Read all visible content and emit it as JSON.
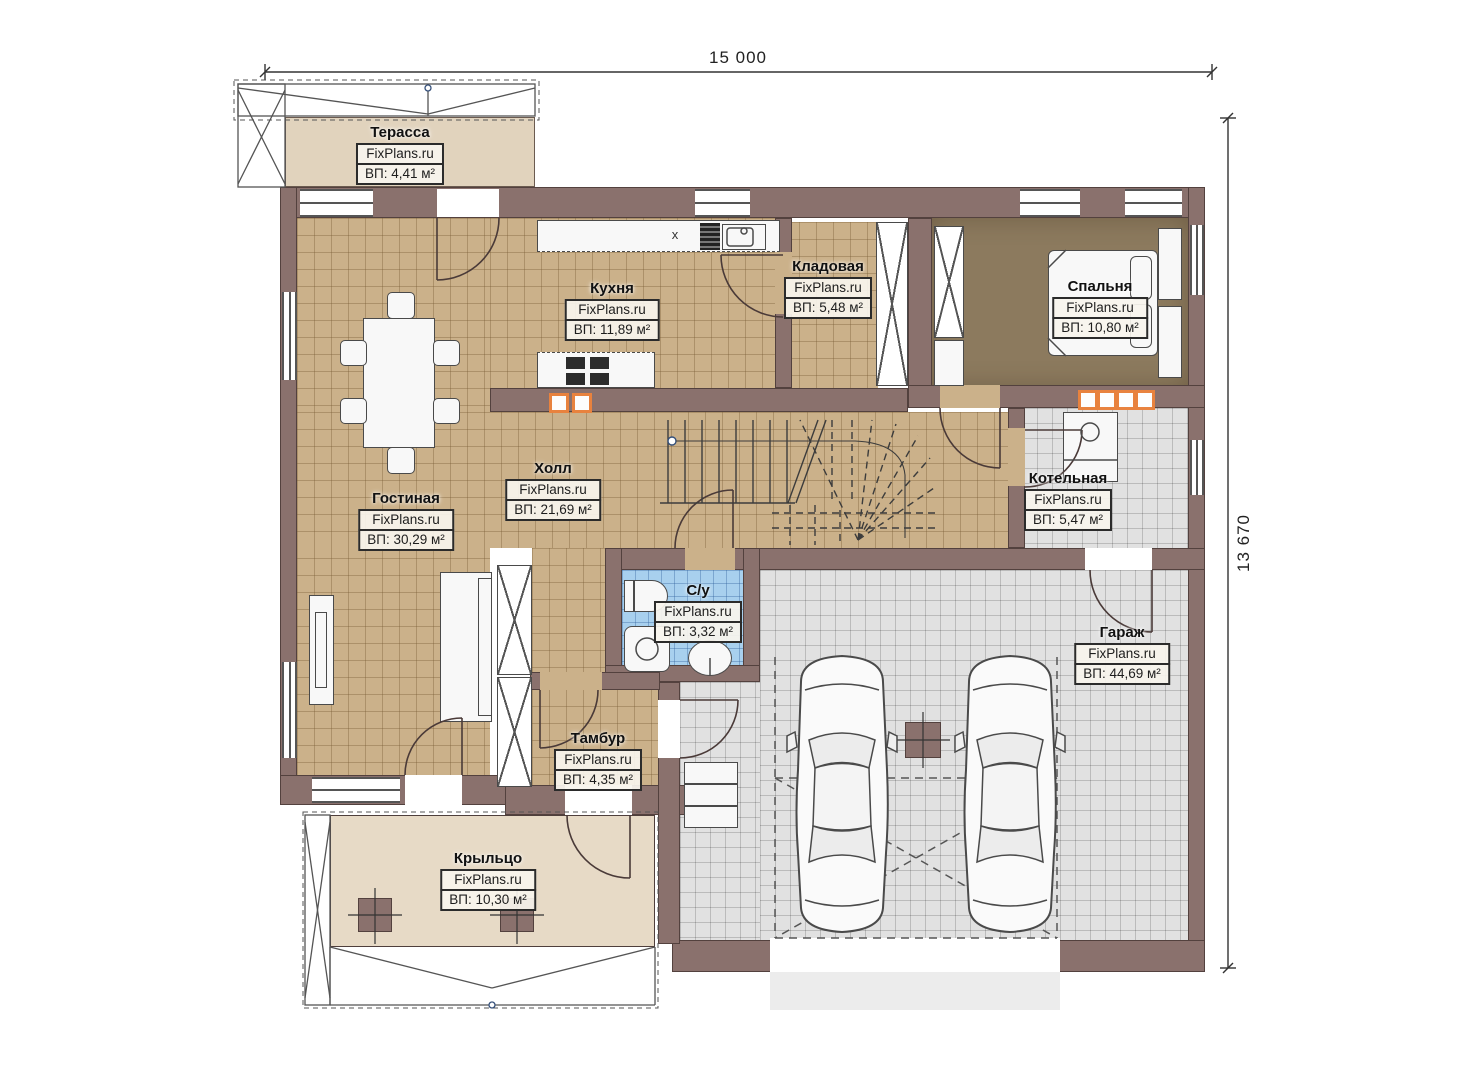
{
  "dimensions": {
    "width": "15 000",
    "height": "13 670"
  },
  "rooms": {
    "terrace": {
      "name": "Терасса",
      "brand": "FixPlans.ru",
      "area": "ВП: 4,41 м²"
    },
    "kitchen": {
      "name": "Кухня",
      "brand": "FixPlans.ru",
      "area": "ВП: 11,89 м²"
    },
    "pantry": {
      "name": "Кладовая",
      "brand": "FixPlans.ru",
      "area": "ВП: 5,48 м²"
    },
    "bedroom": {
      "name": "Спальня",
      "brand": "FixPlans.ru",
      "area": "ВП: 10,80 м²"
    },
    "living": {
      "name": "Гостиная",
      "brand": "FixPlans.ru",
      "area": "ВП: 30,29 м²"
    },
    "hall": {
      "name": "Холл",
      "brand": "FixPlans.ru",
      "area": "ВП: 21,69 м²"
    },
    "boiler": {
      "name": "Котельная",
      "brand": "FixPlans.ru",
      "area": "ВП: 5,47 м²"
    },
    "bathroom": {
      "name": "С/у",
      "brand": "FixPlans.ru",
      "area": "ВП: 3,32 м²"
    },
    "garage": {
      "name": "Гараж",
      "brand": "FixPlans.ru",
      "area": "ВП: 44,69 м²"
    },
    "vestibule": {
      "name": "Тамбур",
      "brand": "FixPlans.ru",
      "area": "ВП: 4,35 м²"
    },
    "porch": {
      "name": "Крыльцо",
      "brand": "FixPlans.ru",
      "area": "ВП: 10,30 м²"
    }
  },
  "symbols": {
    "hob": "x"
  }
}
